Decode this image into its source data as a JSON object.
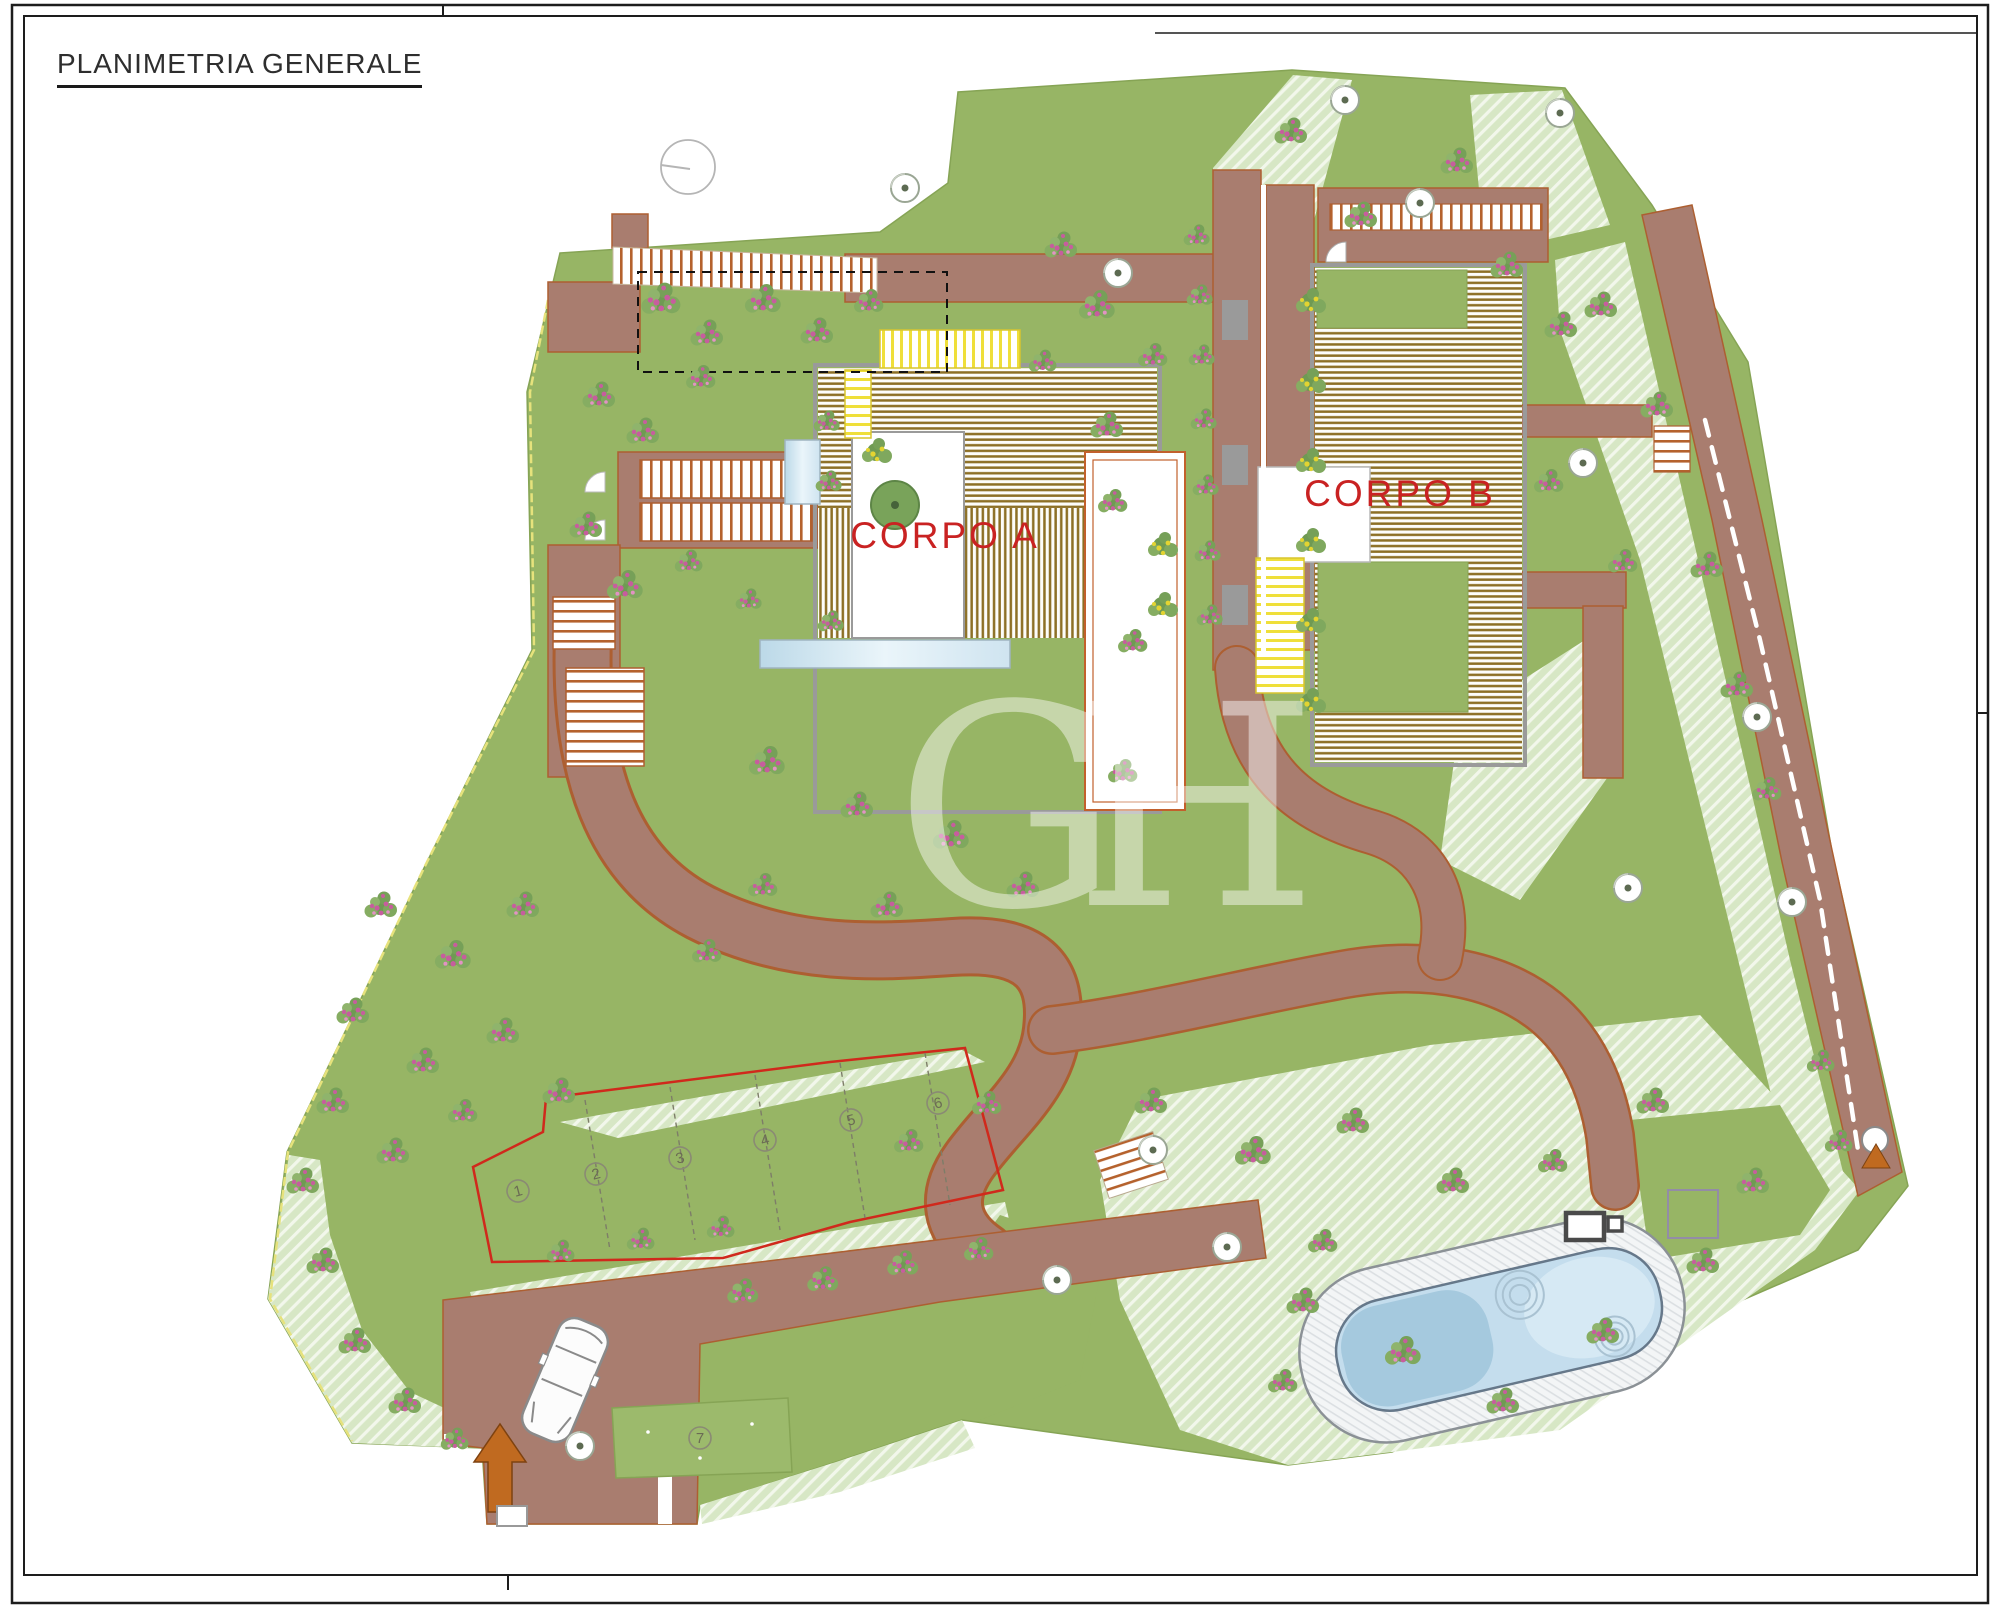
{
  "drawing": {
    "title": "PLANIMETRIA GENERALE",
    "buildings": {
      "a": "CORPO A",
      "b": "CORPO B"
    },
    "watermark": "GH",
    "parking_spaces": [
      "1",
      "2",
      "3",
      "4",
      "5",
      "6",
      "7"
    ],
    "colors": {
      "grass": "#97b565",
      "slope_hatch": "#d7e7c5",
      "path_brown": "#a97d6f",
      "path_outline": "#ad5f31",
      "deck_stripe": "#8d7026",
      "label_red": "#c92222",
      "pool_water": "#c4dded",
      "pool_deck": "#f3f5f6",
      "stair_yellow": "#efdf3a",
      "glass_blue": "#cfe4f0",
      "flower_pink": "#c75d9e",
      "arrow_orange": "#c06a20"
    }
  }
}
